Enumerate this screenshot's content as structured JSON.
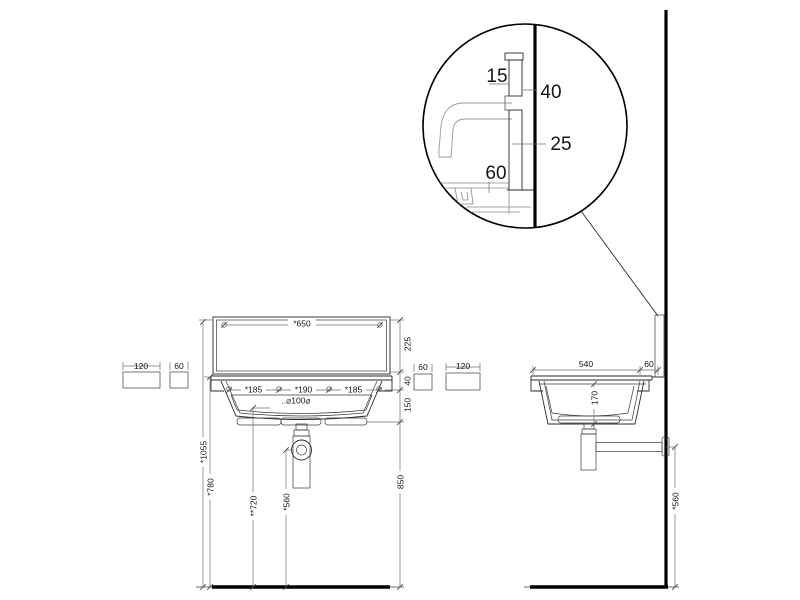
{
  "drawing": {
    "detail": {
      "plate_top": "15",
      "hole_offset": "40",
      "plate_width": "25",
      "rim_gap": "60"
    },
    "front": {
      "width": "*650",
      "panel_height": "225",
      "rim_height": "40",
      "bowl_height": "150",
      "spacing": [
        "*185",
        "*190",
        "*185"
      ],
      "drain": "..⌀100⌀",
      "h_total": "*1055",
      "h_rim": "*780",
      "h_spout": "**720",
      "h_trap": "*560",
      "h_right": "850",
      "box_l1": "120",
      "box_l2": "60",
      "box_r1": "60",
      "box_r2": "120"
    },
    "side": {
      "width": "540",
      "gap": "60",
      "depth": "170",
      "h_trap": "*560"
    }
  }
}
